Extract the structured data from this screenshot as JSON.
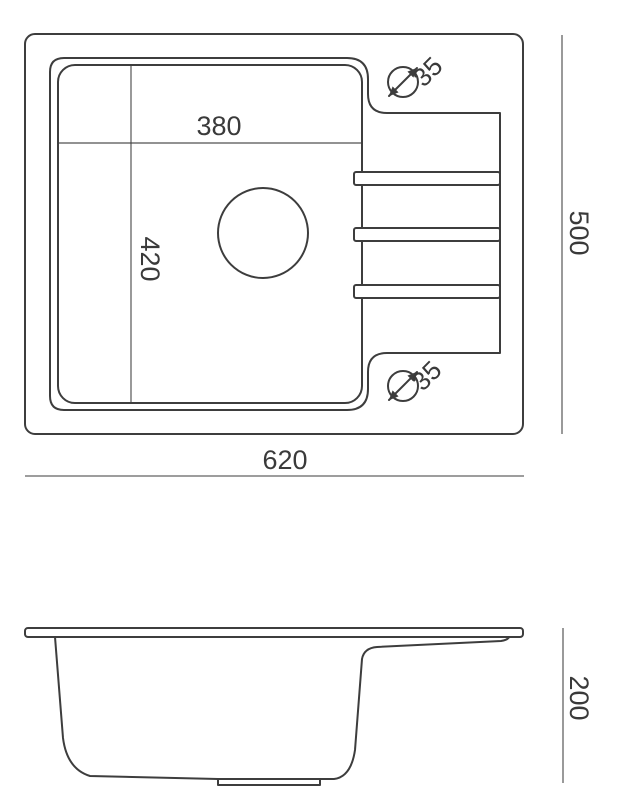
{
  "drawing": {
    "type": "sink-dimension-diagram",
    "colors": {
      "line": "#3d3d3d",
      "dim_line": "#8f8f8f",
      "text": "#3a3a3a",
      "background": "#ffffff"
    },
    "top_view": {
      "bowl_width": "380",
      "bowl_depth": "420",
      "overall_width": "620",
      "overall_depth": "500",
      "tap_hole_top_diameter": "35",
      "tap_hole_bottom_diameter": "35"
    },
    "side_view": {
      "overall_height": "200"
    }
  }
}
